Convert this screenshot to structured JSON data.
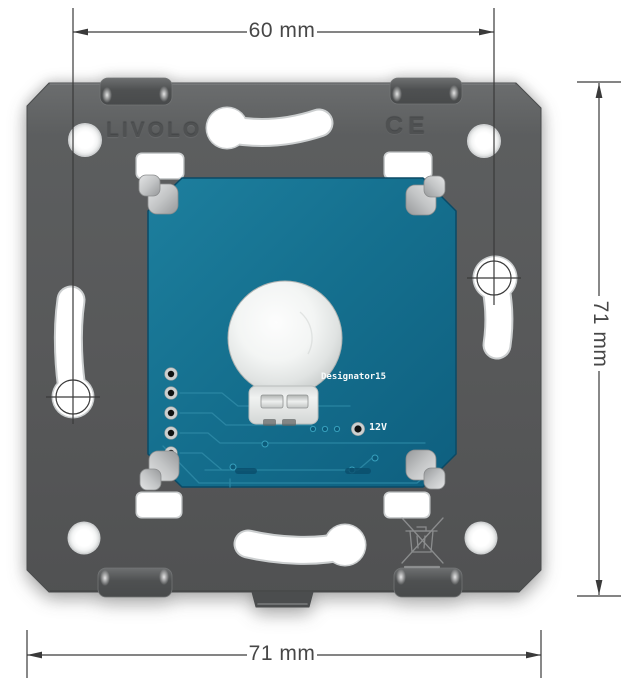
{
  "dimensions": {
    "top": {
      "label": "60 mm"
    },
    "bottom": {
      "label": "71 mm"
    },
    "right": {
      "label": "71 mm"
    }
  },
  "plate": {
    "brand_text": "LIVOLO",
    "ce_text": "CE"
  },
  "pcb": {
    "designator_text": "Designator15",
    "voltage_text": "12V"
  },
  "icons": {
    "weee": "crossed-out-wheelie-bin",
    "crosshair": "dimension-reference-crosshair"
  },
  "colors": {
    "plate_gray": "#575859",
    "pcb_teal": "#15708f",
    "trace_teal": "#2e8aa7",
    "clip_metal": "#c3c5c6",
    "dome_white": "#f3f5f4",
    "annotation": "#3a3a3a",
    "label_text": "#474747"
  }
}
